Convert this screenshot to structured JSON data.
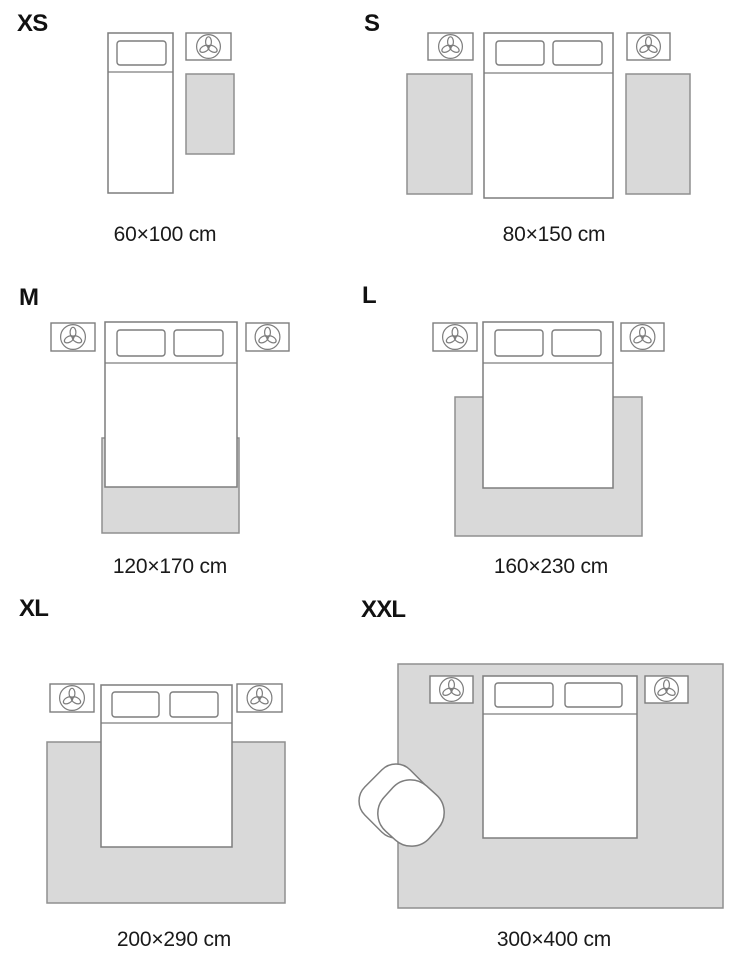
{
  "styles": {
    "background": "#ffffff",
    "line_color": "#7d7d7d",
    "rug_fill": "#d9d9d9",
    "rug_stroke": "#8f8f8f",
    "text_color": "#111111"
  },
  "panels": [
    {
      "id": "xs",
      "label": "XS",
      "caption": "60×100 cm",
      "label_pos": {
        "x": 17,
        "y": 31
      },
      "caption_pos": {
        "cx": 165,
        "y": 241
      },
      "rugs": [
        {
          "x": 186,
          "y": 74,
          "w": 48,
          "h": 80
        }
      ],
      "nightstands": [
        {
          "x": 186,
          "y": 33,
          "w": 45,
          "h": 27
        }
      ],
      "beds": [
        {
          "x": 108,
          "y": 33,
          "w": 65,
          "h": 160,
          "divider_y": 72,
          "pillows": [
            {
              "x": 117,
              "y": 41,
              "w": 49,
              "h": 24
            }
          ]
        }
      ],
      "armchairs": []
    },
    {
      "id": "s",
      "label": "S",
      "caption": "80×150 cm",
      "label_pos": {
        "x": 364,
        "y": 31
      },
      "caption_pos": {
        "cx": 554,
        "y": 241
      },
      "rugs": [
        {
          "x": 407,
          "y": 74,
          "w": 65,
          "h": 120
        },
        {
          "x": 626,
          "y": 74,
          "w": 64,
          "h": 120
        }
      ],
      "nightstands": [
        {
          "x": 428,
          "y": 33,
          "w": 45,
          "h": 27
        },
        {
          "x": 627,
          "y": 33,
          "w": 43,
          "h": 27
        }
      ],
      "beds": [
        {
          "x": 484,
          "y": 33,
          "w": 129,
          "h": 165,
          "divider_y": 73,
          "pillows": [
            {
              "x": 496,
              "y": 41,
              "w": 48,
              "h": 24
            },
            {
              "x": 553,
              "y": 41,
              "w": 49,
              "h": 24
            }
          ]
        }
      ],
      "armchairs": []
    },
    {
      "id": "m",
      "label": "M",
      "caption": "120×170 cm",
      "label_pos": {
        "x": 19,
        "y": 305
      },
      "caption_pos": {
        "cx": 170,
        "y": 573
      },
      "rugs": [
        {
          "x": 102,
          "y": 438,
          "w": 137,
          "h": 95
        }
      ],
      "nightstands": [
        {
          "x": 51,
          "y": 323,
          "w": 44,
          "h": 28
        },
        {
          "x": 246,
          "y": 323,
          "w": 43,
          "h": 28
        }
      ],
      "beds": [
        {
          "x": 105,
          "y": 322,
          "w": 132,
          "h": 165,
          "divider_y": 363,
          "pillows": [
            {
              "x": 117,
              "y": 330,
              "w": 48,
              "h": 26
            },
            {
              "x": 174,
              "y": 330,
              "w": 49,
              "h": 26
            }
          ]
        }
      ],
      "armchairs": []
    },
    {
      "id": "l",
      "label": "L",
      "caption": "160×230 cm",
      "label_pos": {
        "x": 362,
        "y": 303
      },
      "caption_pos": {
        "cx": 551,
        "y": 573
      },
      "rugs": [
        {
          "x": 455,
          "y": 397,
          "w": 187,
          "h": 139
        }
      ],
      "nightstands": [
        {
          "x": 433,
          "y": 323,
          "w": 44,
          "h": 28
        },
        {
          "x": 621,
          "y": 323,
          "w": 43,
          "h": 28
        }
      ],
      "beds": [
        {
          "x": 483,
          "y": 322,
          "w": 130,
          "h": 166,
          "divider_y": 363,
          "pillows": [
            {
              "x": 495,
              "y": 330,
              "w": 48,
              "h": 26
            },
            {
              "x": 552,
              "y": 330,
              "w": 49,
              "h": 26
            }
          ]
        }
      ],
      "armchairs": []
    },
    {
      "id": "xl",
      "label": "XL",
      "caption": "200×290 cm",
      "label_pos": {
        "x": 19,
        "y": 616
      },
      "caption_pos": {
        "cx": 174,
        "y": 946
      },
      "rugs": [
        {
          "x": 47,
          "y": 742,
          "w": 238,
          "h": 161
        }
      ],
      "nightstands": [
        {
          "x": 50,
          "y": 684,
          "w": 44,
          "h": 28
        },
        {
          "x": 237,
          "y": 684,
          "w": 45,
          "h": 28
        }
      ],
      "beds": [
        {
          "x": 101,
          "y": 685,
          "w": 131,
          "h": 162,
          "divider_y": 723,
          "pillows": [
            {
              "x": 112,
              "y": 692,
              "w": 47,
              "h": 25
            },
            {
              "x": 170,
              "y": 692,
              "w": 48,
              "h": 25
            }
          ]
        }
      ],
      "armchairs": []
    },
    {
      "id": "xxl",
      "label": "XXL",
      "caption": "300×400 cm",
      "label_pos": {
        "x": 361,
        "y": 617
      },
      "caption_pos": {
        "cx": 554,
        "y": 946
      },
      "rugs": [
        {
          "x": 398,
          "y": 664,
          "w": 325,
          "h": 244
        }
      ],
      "nightstands": [
        {
          "x": 430,
          "y": 676,
          "w": 43,
          "h": 27
        },
        {
          "x": 645,
          "y": 676,
          "w": 43,
          "h": 27
        }
      ],
      "beds": [
        {
          "x": 483,
          "y": 676,
          "w": 154,
          "h": 162,
          "divider_y": 714,
          "pillows": [
            {
              "x": 495,
              "y": 683,
              "w": 58,
              "h": 24
            },
            {
              "x": 565,
              "y": 683,
              "w": 57,
              "h": 24
            }
          ]
        }
      ],
      "armchairs": [
        {
          "back": {
            "cx": 396,
            "cy": 801,
            "size": 64,
            "rx": 20,
            "rot": 45
          },
          "seat": {
            "cx": 411,
            "cy": 813,
            "size": 61,
            "rx": 24,
            "rot": 42
          }
        }
      ]
    }
  ]
}
